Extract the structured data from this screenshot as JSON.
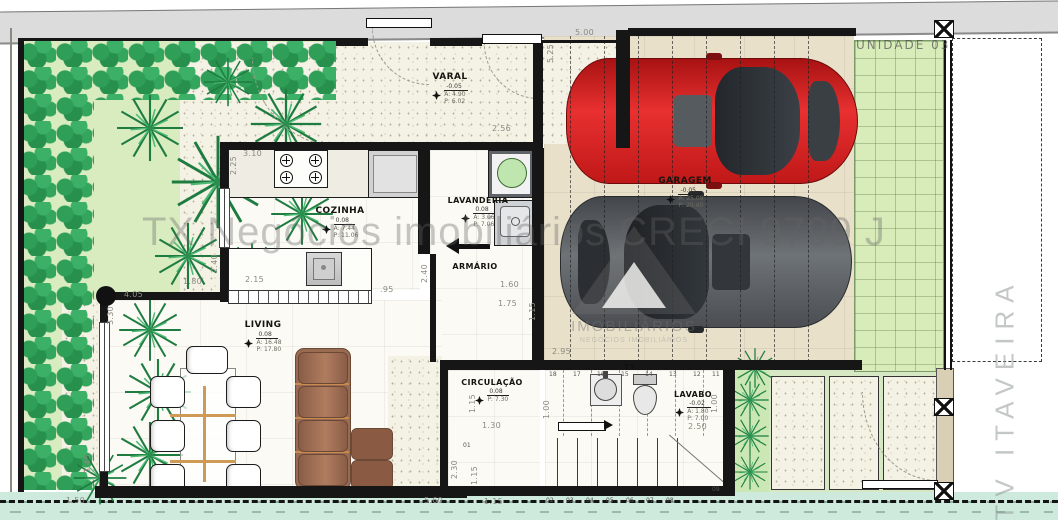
{
  "labels": {
    "unit": "UNIDADE 03",
    "street": "TV ITAVEIRA",
    "watermark": "TX Negócios imobiliários CRECI 9799 J",
    "logo_caption": "IMOBILIÁRIOS",
    "logo_sub": "NEGÓCIOS IMOBILIÁRIOS"
  },
  "rooms": {
    "varal": {
      "name": "VARAL",
      "level": "-0.05",
      "area": "A: 4.90",
      "perim": "P: 6.02"
    },
    "cozinha": {
      "name": "COZINHA",
      "level": "0.08",
      "area": "A: 7.44",
      "perim": "P: 11.06"
    },
    "lavanderia": {
      "name": "LAVANDERIA",
      "level": "0.08",
      "area": "A: 3.06",
      "perim": "P: 7.06"
    },
    "armario": {
      "name": "ARMÁRIO"
    },
    "garagem": {
      "name": "GARAGEM",
      "level": "-0.05",
      "area": "A: 25.08",
      "perim": "P: 20.40"
    },
    "living": {
      "name": "LIVING",
      "level": "0.08",
      "area": "A: 16.48",
      "perim": "P: 17.80"
    },
    "circulacao": {
      "name": "CIRCULAÇÃO",
      "level": "0.08",
      "area": "A: 2.50",
      "perim": "P: 7.30"
    },
    "lavabo": {
      "name": "LAVABO",
      "level": "-0.02",
      "area": "A: 1.80",
      "perim": "P: 7.00"
    }
  },
  "dims": {
    "d500": "5.00",
    "d525": "5.25",
    "d256": "2.56",
    "d310": "3.10",
    "d225": "2.25",
    "d240a": "2.40",
    "d215": "2.15",
    "d095": ".95",
    "d240b": "2.40",
    "d180": "1.80",
    "d405": "4.05",
    "d330": "3.30",
    "d160": "1.60",
    "d175": "1.75",
    "d115a": "1.15",
    "d295": "2.95",
    "d115b": "1.15",
    "d130": "1.30",
    "d100a": "1.00",
    "d250": "2.50",
    "d100b": "1.00",
    "d230": "2.30",
    "d115c": "1.15",
    "d115d": "1.15",
    "d560": "5.60",
    "d150": "1.50",
    "d345": "3.45"
  },
  "stairs": {
    "top": [
      "18",
      "17",
      "16",
      "15",
      "14",
      "13",
      "12",
      "11"
    ],
    "bottom": [
      "02",
      "03",
      "04",
      "05",
      "06",
      "07",
      "08"
    ],
    "corner": "09",
    "start": "01"
  },
  "symbols": {
    "register": "TT"
  },
  "colors": {
    "garden": "#d9ecc0",
    "bush": "#2f9e57",
    "paver": "#d8ecb9",
    "car_red": "#d92121",
    "car_gray": "#5c6064",
    "sofa": "#9a6b53",
    "sidewalk_top": "#dcdcdc",
    "sidewalk_bottom": "#cdeadd",
    "wall": "#161616",
    "garage_floor": "#e9e0ca"
  }
}
